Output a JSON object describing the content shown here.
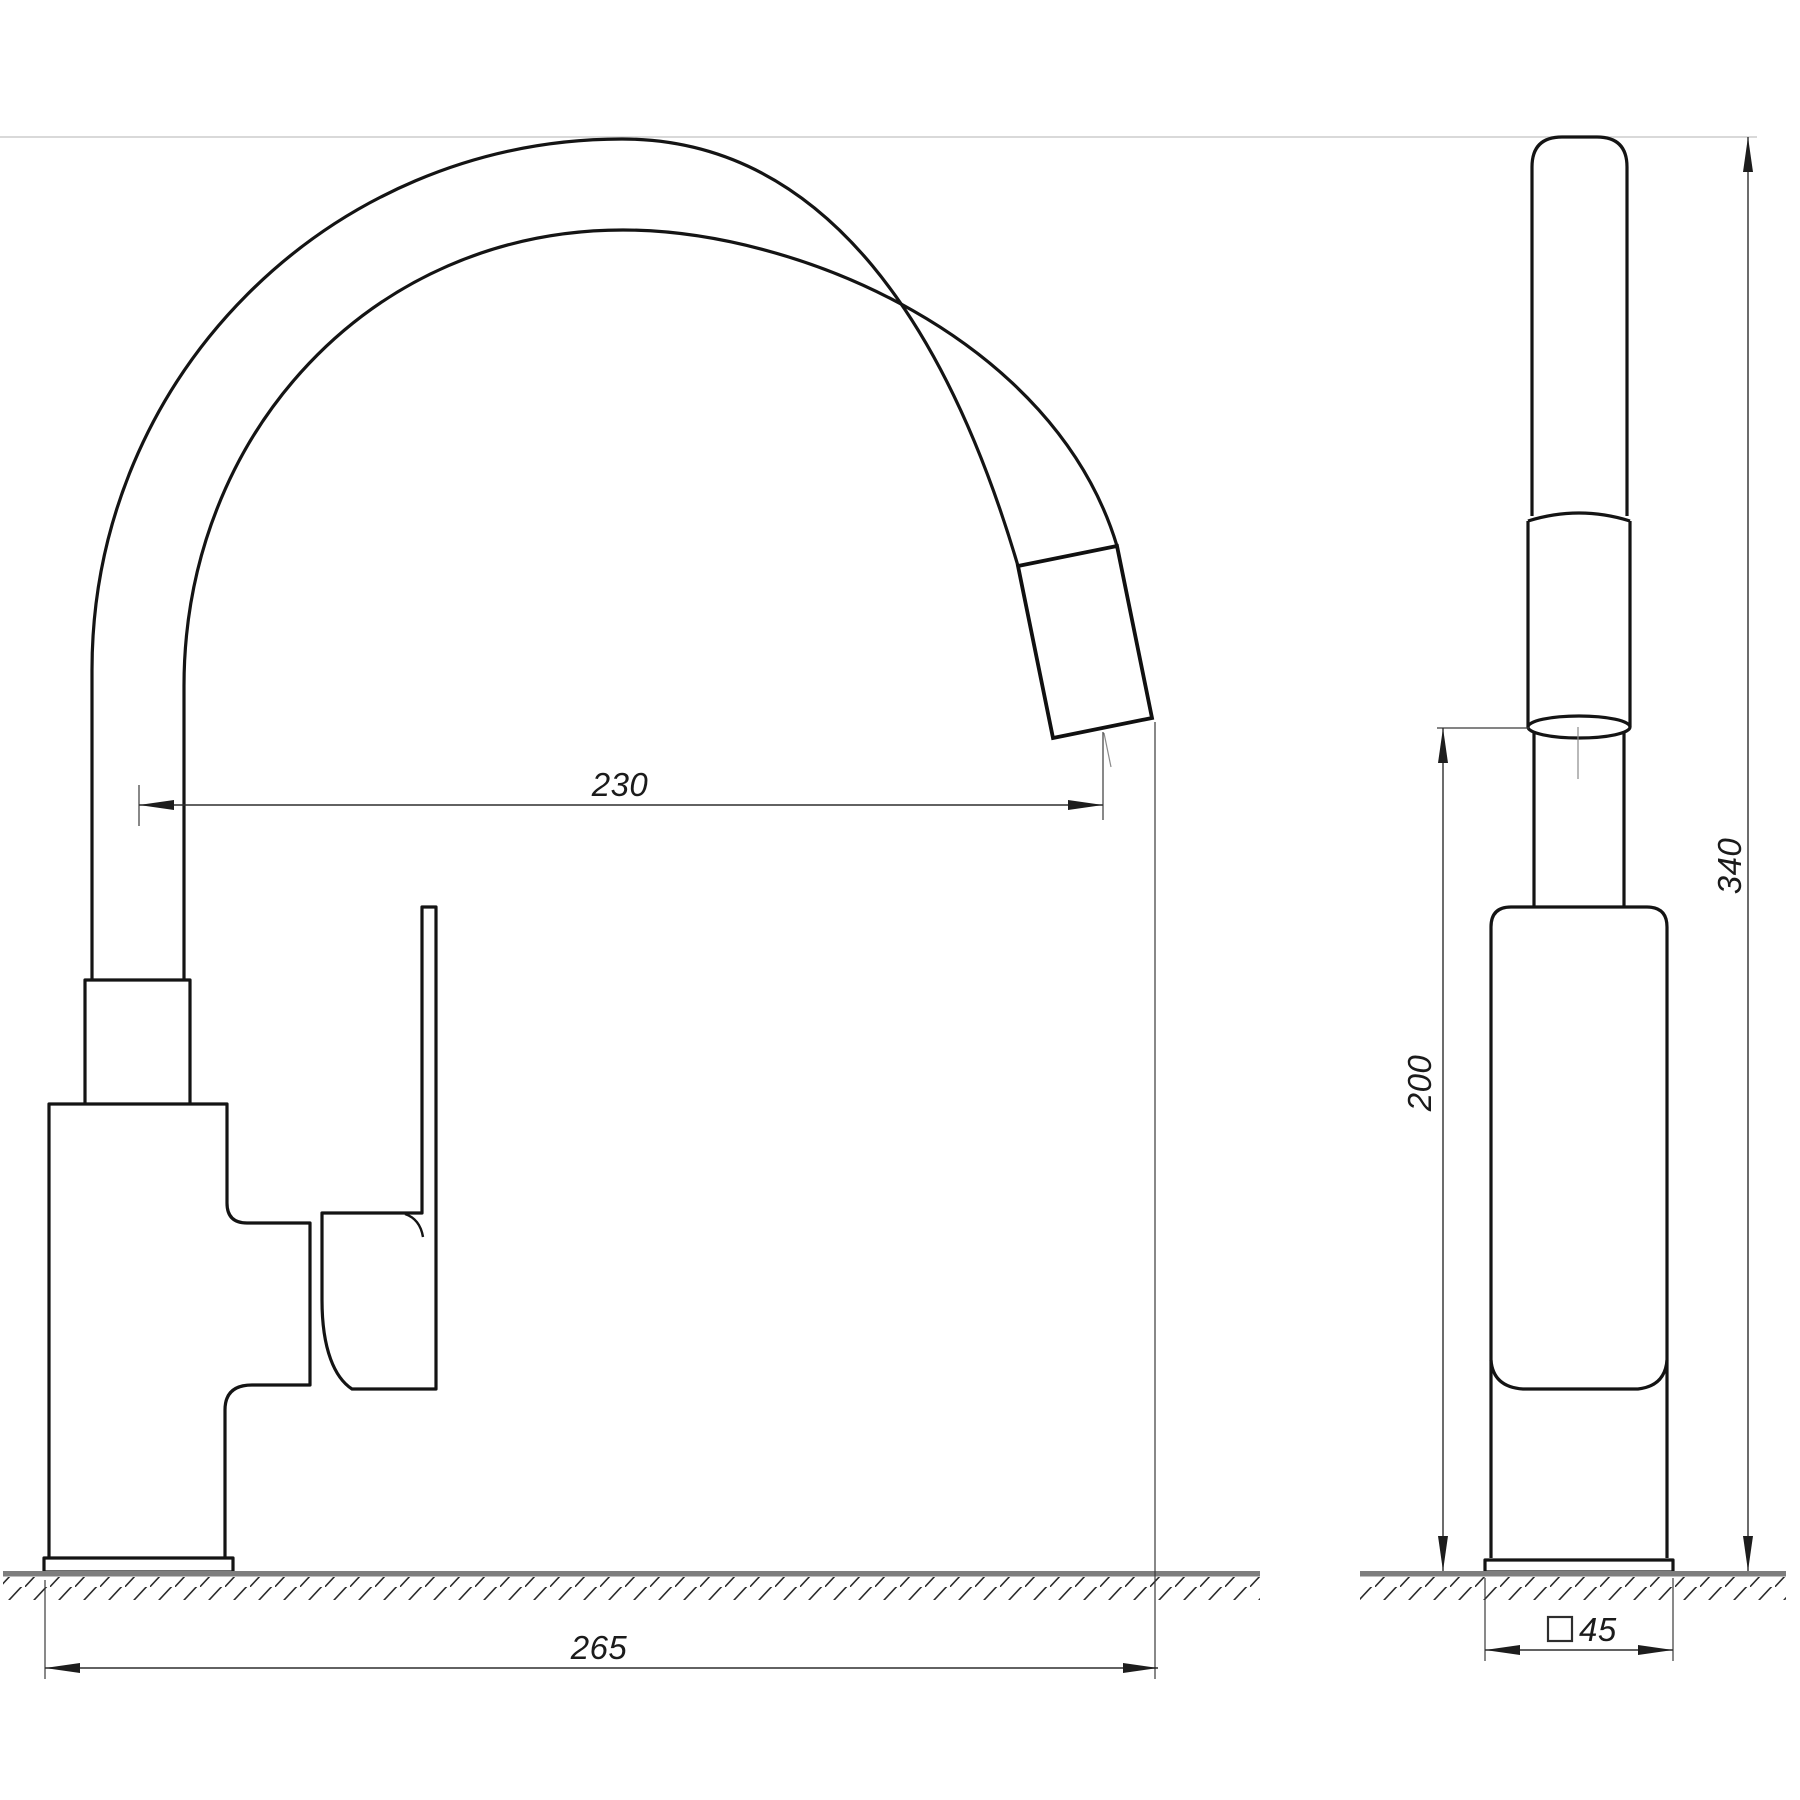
{
  "dimensions": {
    "spout_reach": "230",
    "overall_depth": "265",
    "outlet_height": "200",
    "overall_height": "340",
    "base_prefix": "□",
    "base_size": "45"
  }
}
